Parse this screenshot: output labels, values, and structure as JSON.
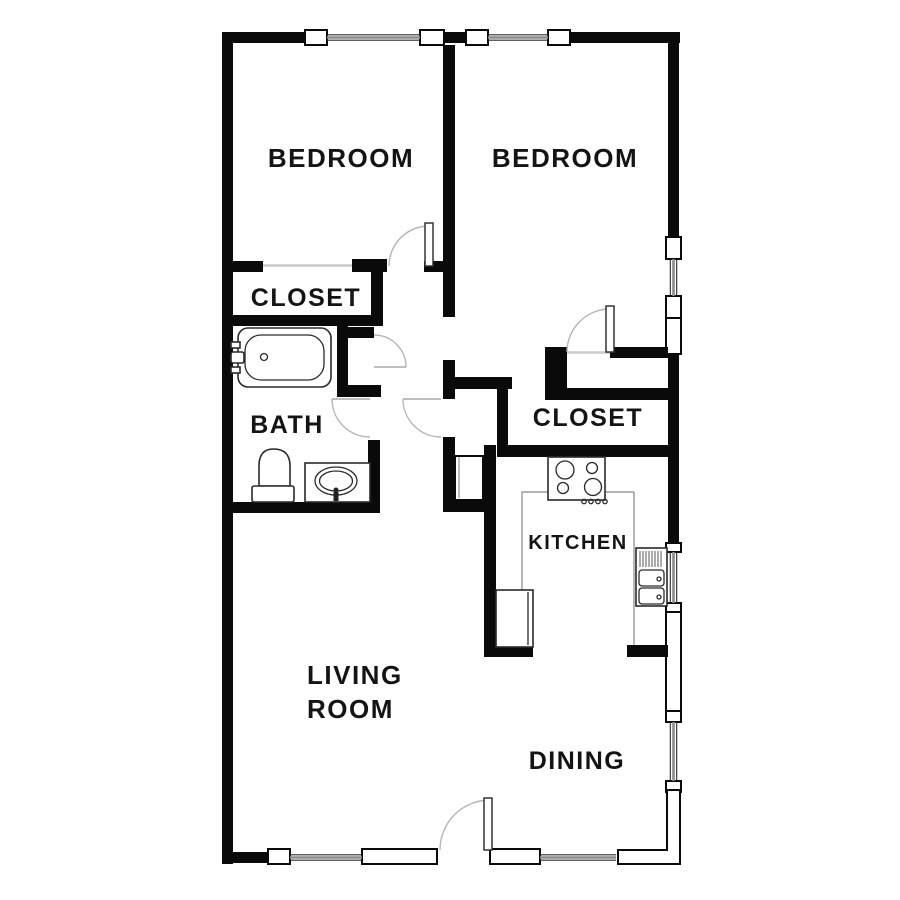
{
  "plan": {
    "colors": {
      "wall": "#0a0a0a",
      "fixture": "#2a2a2a",
      "door_arc": "#b5b5b5",
      "threshold": "#c9c9c9",
      "counter": "#888888",
      "label": "#141414",
      "background": "#ffffff"
    },
    "rooms": {
      "bedroom_left": {
        "label": "BEDROOM"
      },
      "bedroom_right": {
        "label": "BEDROOM"
      },
      "closet_left": {
        "label": "CLOSET"
      },
      "bath": {
        "label": "BATH"
      },
      "closet_right": {
        "label": "CLOSET"
      },
      "kitchen": {
        "label": "KITCHEN"
      },
      "living_room": {
        "label_line1": "LIVING",
        "label_line2": "ROOM"
      },
      "dining": {
        "label": "DINING"
      }
    },
    "fixtures": [
      "bathtub",
      "toilet",
      "bathroom-sink",
      "kitchen-stove",
      "kitchen-sink",
      "refrigerator",
      "kitchen-counter"
    ]
  }
}
